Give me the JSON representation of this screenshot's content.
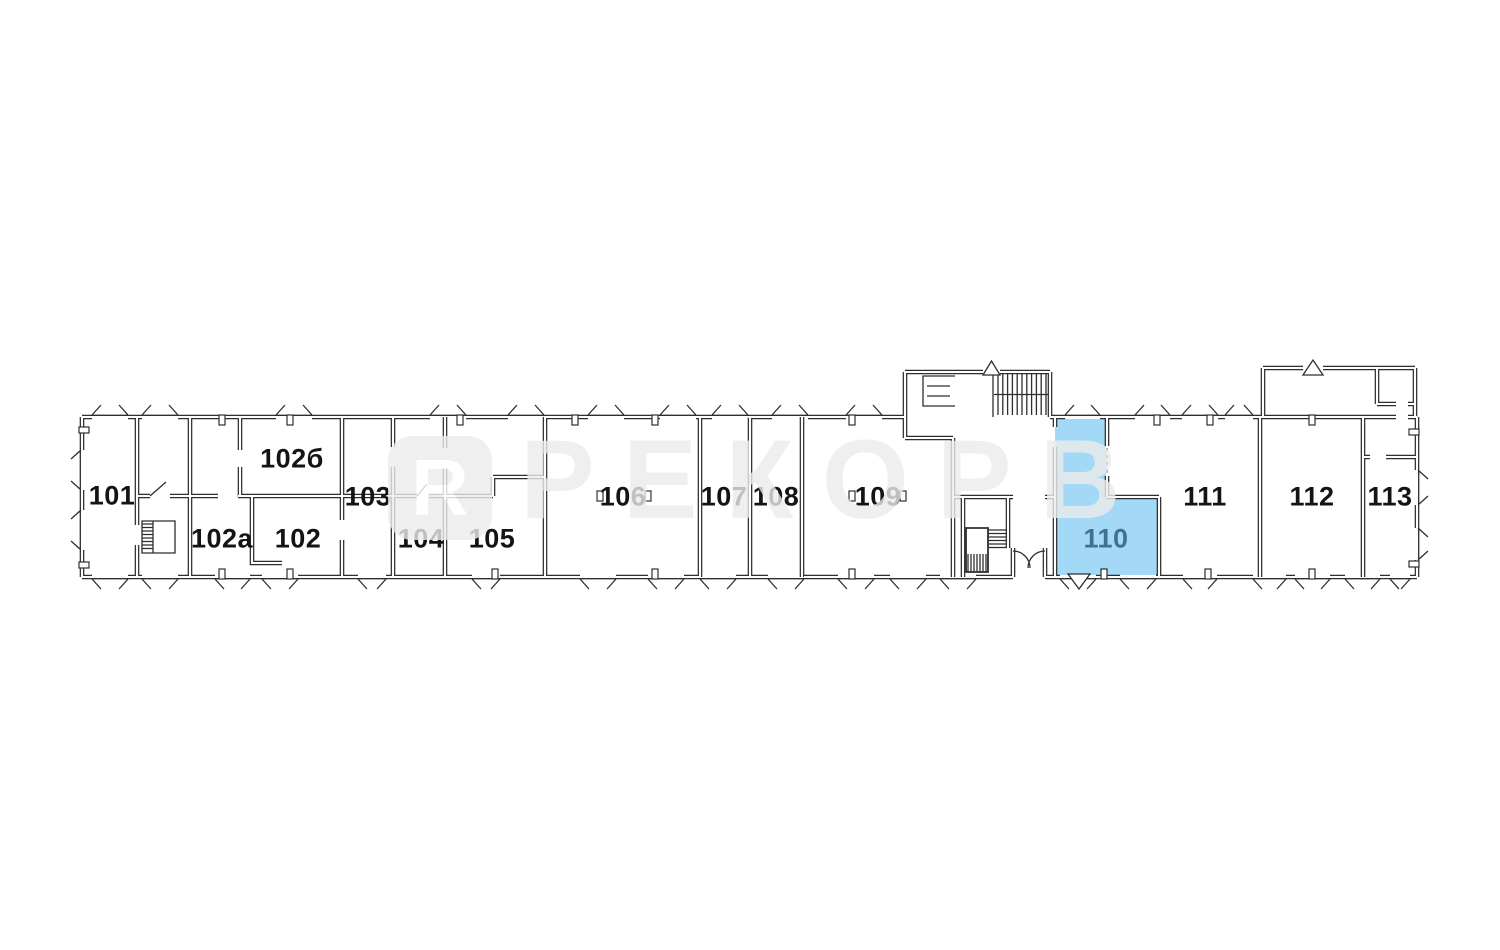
{
  "watermark": {
    "logo_letter": "R",
    "text": "РЕКОРВ"
  },
  "colors": {
    "background": "#ffffff",
    "line": "#2e2e2e",
    "highlight_fill": "#a3d9f6",
    "highlight_text": "#3f7096",
    "label_text": "#141414",
    "watermark": "#ececec"
  },
  "rooms": [
    {
      "label": "101",
      "x": 112,
      "y": 496,
      "highlighted": false
    },
    {
      "label": "102а",
      "x": 222,
      "y": 539,
      "highlighted": false
    },
    {
      "label": "102",
      "x": 298,
      "y": 539,
      "highlighted": false
    },
    {
      "label": "102б",
      "x": 292,
      "y": 459,
      "highlighted": false
    },
    {
      "label": "103",
      "x": 368,
      "y": 497,
      "highlighted": false
    },
    {
      "label": "104",
      "x": 421,
      "y": 539,
      "highlighted": false
    },
    {
      "label": "105",
      "x": 492,
      "y": 539,
      "highlighted": false
    },
    {
      "label": "106",
      "x": 623,
      "y": 497,
      "highlighted": false
    },
    {
      "label": "107",
      "x": 724,
      "y": 497,
      "highlighted": false
    },
    {
      "label": "108",
      "x": 776,
      "y": 497,
      "highlighted": false
    },
    {
      "label": "109",
      "x": 878,
      "y": 497,
      "highlighted": false
    },
    {
      "label": "110",
      "x": 1106,
      "y": 539,
      "highlighted": true
    },
    {
      "label": "111",
      "x": 1205,
      "y": 497,
      "highlighted": false
    },
    {
      "label": "112",
      "x": 1312,
      "y": 497,
      "highlighted": false
    },
    {
      "label": "113",
      "x": 1390,
      "y": 497,
      "highlighted": false
    }
  ]
}
